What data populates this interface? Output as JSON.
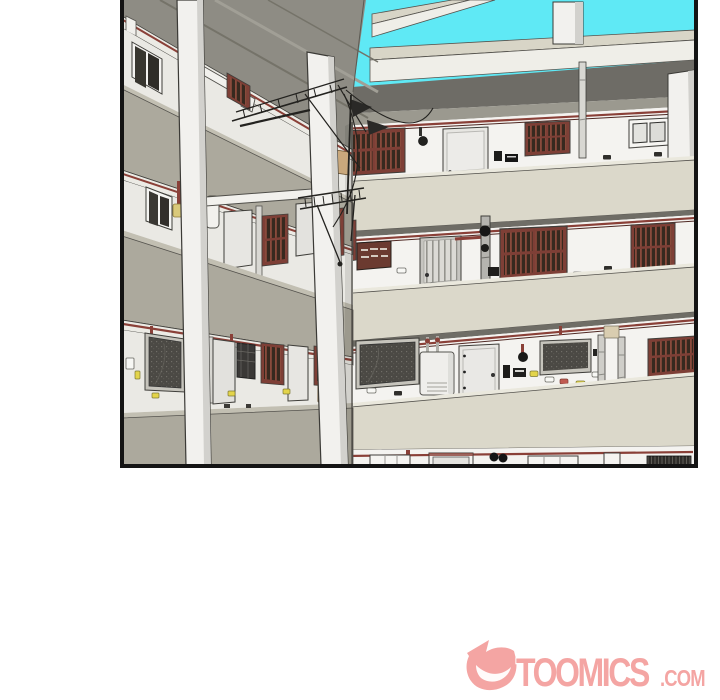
{
  "page": {
    "width": 720,
    "height": 700
  },
  "panel": {
    "kind": "comic-panel",
    "border_color": "#141414",
    "scene": "3D apartment building inner courtyard seen from a corner walkway; four corridor floors with lattice windows, doors, meters and pipes; sky visible through roof beams; two foreground pillars and rooftop antennas"
  },
  "palette": {
    "background": "#FFFFFF",
    "sky": "#5FE9F5",
    "beam_top": "#D8D5C7",
    "beam_face": "#EFEEE8",
    "soffit_dark": "#6E6C66",
    "soffit_light": "#9B998F",
    "left_roof": "#8E8C84",
    "wall_white": "#F4F3F0",
    "left_wall": "#EAE9E4",
    "parapet": "#DBD8CA",
    "parapet_top": "#EAE8DD",
    "parapet_left": "#ACA99D",
    "parapet_left_top": "#C2BFB2",
    "fascia": "#ECEBE5",
    "floor_strip": "#6F6D66",
    "pipe_red": "#8A4038",
    "pipe_red_dark": "#4F2823",
    "lattice_frame": "#7E3F36",
    "mesh_frame": "#C6C4BC",
    "pillar": "#F2F1EE",
    "pillar_shade": "#D2D1CD",
    "door_light": "#E7E6E2",
    "yellow_meter": "#E3D44A",
    "tan_panel": "#C9A87C",
    "outline": "#3F3E3A",
    "border": "#141414",
    "watermark": "#F4A5A3"
  },
  "watermark": {
    "text": "TOOMICS",
    "suffix": ".COM",
    "icon": "toomics-grin-logo",
    "color": "#F4A5A3"
  }
}
